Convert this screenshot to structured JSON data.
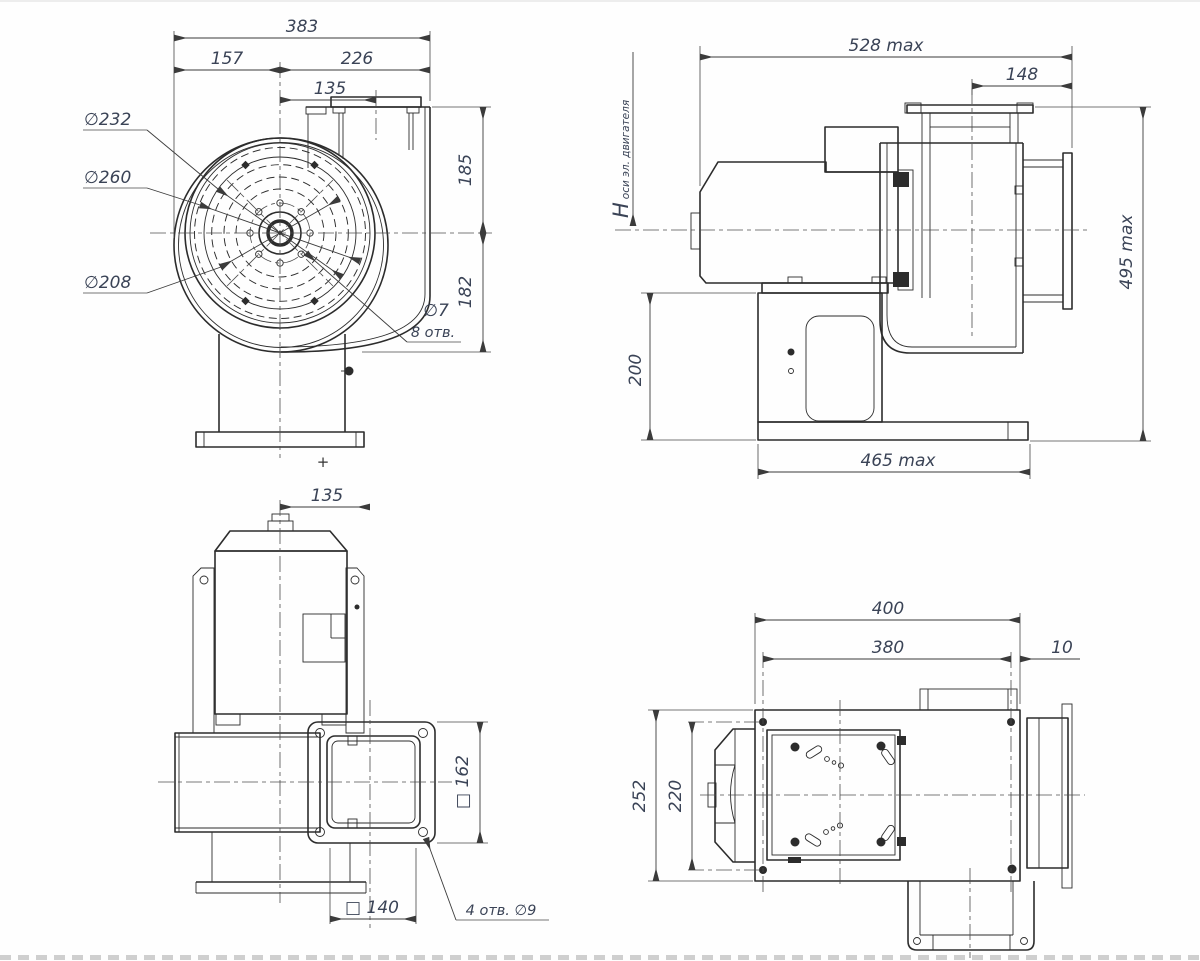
{
  "front": {
    "dim_width_total": "383",
    "dim_width_left": "157",
    "dim_width_right": "226",
    "dim_outlet_offset": "135",
    "dim_height_upper": "185",
    "dim_height_lower": "182",
    "label_d232": "∅232",
    "label_d260": "∅260",
    "label_d208": "∅208",
    "label_holes_dia": "∅7",
    "label_holes_count": "8 отв.",
    "center_mark": "+"
  },
  "side": {
    "dim_length_max": "528 max",
    "dim_inlet_depth": "148",
    "dim_height_max": "495 max",
    "dim_pedestal_height": "200",
    "dim_base_length": "465 max",
    "label_axis_h": "H",
    "label_axis_sub": "оси эл. двигателя"
  },
  "top": {
    "dim_outlet_offset": "135",
    "dim_outlet_square": "□ 162",
    "dim_flange_square": "□ 140",
    "label_flange_holes": "4 отв. ∅9"
  },
  "bottom": {
    "dim_base_width": "400",
    "dim_holes_span": "380",
    "dim_hole_edge": "10",
    "dim_base_depth": "252",
    "dim_holes_span_depth": "220"
  }
}
